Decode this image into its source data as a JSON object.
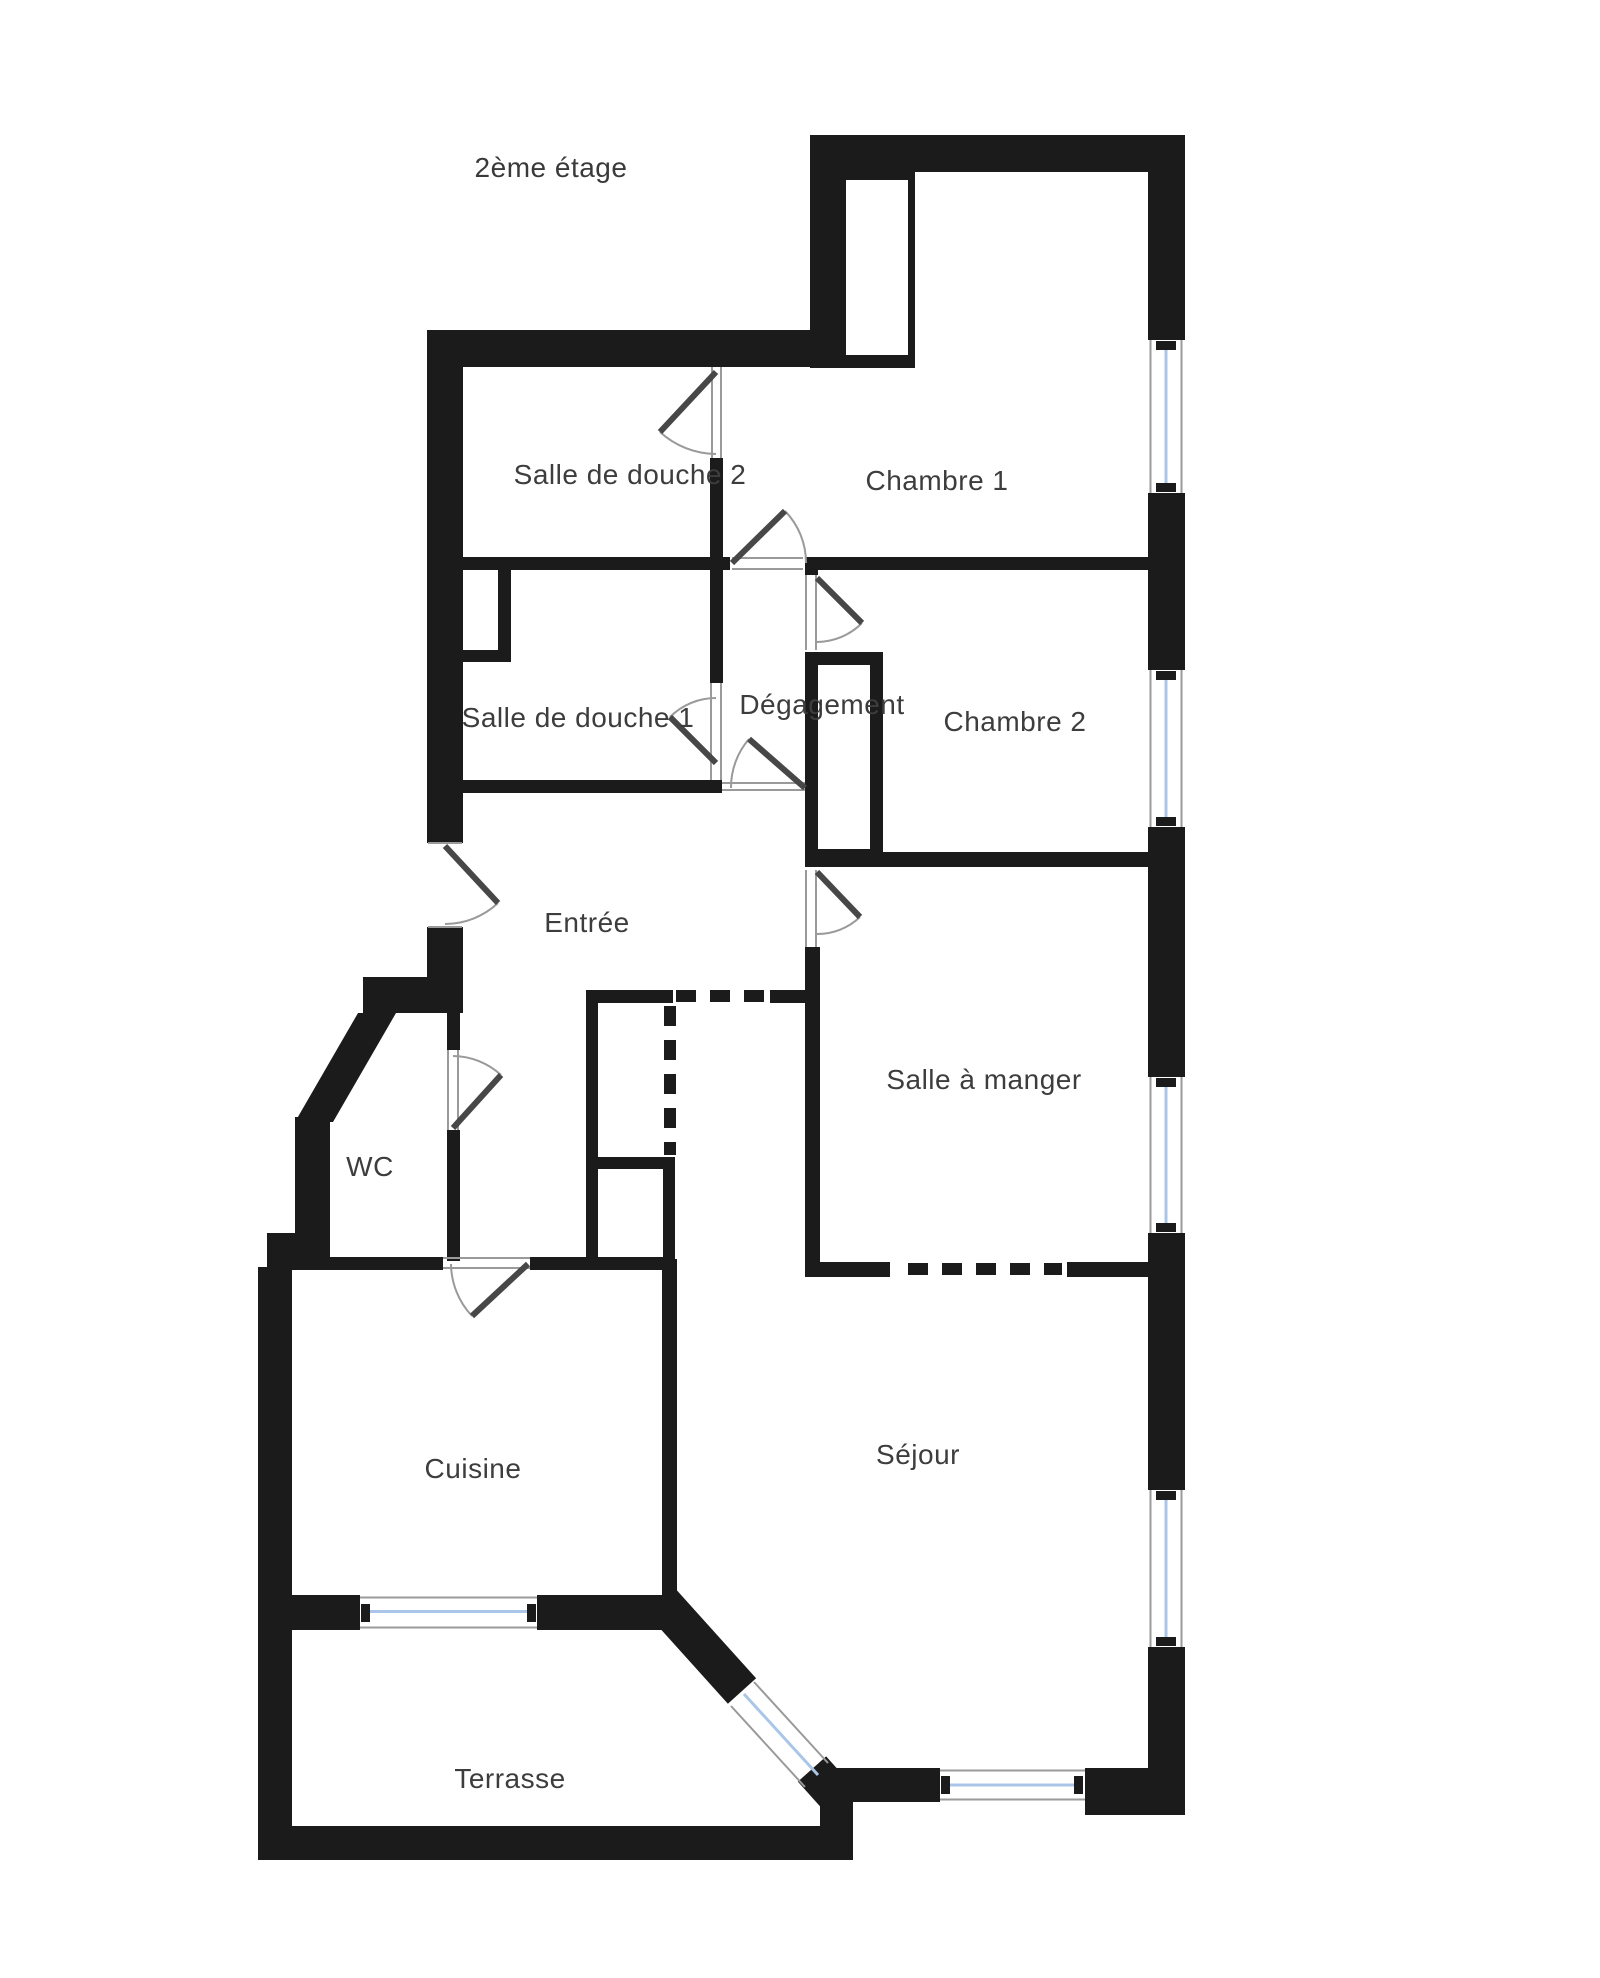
{
  "title": {
    "text": "2ème étage"
  },
  "colors": {
    "wall": "#1b1b1b",
    "leaf": "#474747",
    "arc": "#9a9a9a",
    "thin": "#9a9a9a",
    "glass": "#a9c6e8",
    "label": "#3d3d3d",
    "background": "#ffffff"
  },
  "rooms": [
    {
      "id": "salle-de-douche-2",
      "label": "Salle de douche 2",
      "x": 630,
      "y": 475
    },
    {
      "id": "chambre-1",
      "label": "Chambre 1",
      "x": 937,
      "y": 481
    },
    {
      "id": "salle-de-douche-1",
      "label": "Salle de douche 1",
      "x": 578,
      "y": 718
    },
    {
      "id": "degagement",
      "label": "Dégagement",
      "x": 822,
      "y": 705
    },
    {
      "id": "chambre-2",
      "label": "Chambre 2",
      "x": 1015,
      "y": 722
    },
    {
      "id": "entree",
      "label": "Entrée",
      "x": 587,
      "y": 923
    },
    {
      "id": "salle-a-manger",
      "label": "Salle à manger",
      "x": 984,
      "y": 1080
    },
    {
      "id": "wc",
      "label": "WC",
      "x": 370,
      "y": 1167
    },
    {
      "id": "cuisine",
      "label": "Cuisine",
      "x": 473,
      "y": 1469
    },
    {
      "id": "sejour",
      "label": "Séjour",
      "x": 918,
      "y": 1455
    },
    {
      "id": "terrasse",
      "label": "Terrasse",
      "x": 510,
      "y": 1779
    }
  ],
  "title_pos": {
    "x": 551,
    "y": 168
  },
  "floorplan": {
    "walls": [
      [
        810,
        135,
        375,
        37
      ],
      [
        810,
        172,
        105,
        196
      ],
      [
        427,
        330,
        423,
        37
      ],
      [
        427,
        330,
        36,
        513
      ],
      [
        427,
        927,
        36,
        86
      ],
      [
        363,
        977,
        100,
        36
      ],
      [
        295,
        1117,
        35,
        121
      ],
      [
        267,
        1233,
        63,
        34
      ],
      [
        258,
        1267,
        34,
        559
      ],
      [
        258,
        1826,
        595,
        34
      ],
      [
        258,
        1595,
        102,
        35
      ],
      [
        537,
        1595,
        126,
        35
      ],
      [
        662,
        1259,
        15,
        338
      ],
      [
        1148,
        172,
        37,
        168
      ],
      [
        1148,
        493,
        37,
        177
      ],
      [
        1148,
        827,
        37,
        250
      ],
      [
        1148,
        1233,
        37,
        257
      ],
      [
        1148,
        1647,
        37,
        168
      ],
      [
        827,
        1768,
        113,
        34
      ],
      [
        1085,
        1768,
        100,
        47
      ],
      [
        820,
        1768,
        33,
        92
      ],
      [
        463,
        557,
        267,
        13
      ],
      [
        805,
        557,
        343,
        13
      ],
      [
        805,
        557,
        13,
        18
      ],
      [
        710,
        458,
        13,
        225
      ],
      [
        463,
        780,
        259,
        13
      ],
      [
        498,
        568,
        13,
        94
      ],
      [
        463,
        650,
        48,
        12
      ],
      [
        805,
        652,
        13,
        210
      ],
      [
        805,
        652,
        78,
        13
      ],
      [
        870,
        652,
        13,
        210
      ],
      [
        805,
        849,
        78,
        13
      ],
      [
        805,
        947,
        15,
        330
      ],
      [
        805,
        852,
        343,
        15
      ],
      [
        586,
        990,
        87,
        13
      ],
      [
        770,
        990,
        38,
        13
      ],
      [
        586,
        990,
        12,
        280
      ],
      [
        593,
        1157,
        80,
        12
      ],
      [
        663,
        1157,
        12,
        113
      ],
      [
        447,
        1013,
        13,
        37
      ],
      [
        447,
        1130,
        13,
        131
      ],
      [
        267,
        1257,
        176,
        13
      ],
      [
        530,
        1257,
        133,
        13
      ],
      [
        805,
        1262,
        85,
        15
      ],
      [
        1067,
        1262,
        81,
        15
      ]
    ],
    "white_cores": [
      [
        846,
        180,
        62,
        175
      ]
    ],
    "wall_polygons": [
      "358,1013 295,1122 333,1122 396,1013"
    ],
    "thick_diagonals": [
      [
        660,
        1600,
        742,
        1691
      ],
      [
        812,
        1769,
        838,
        1798
      ]
    ],
    "windows_right": {
      "x": 1147,
      "w": 39,
      "frame_x": [
        1150.5,
        1181.5
      ],
      "glass_x": 1166,
      "nub": {
        "x": 1156,
        "w": 20,
        "h": 9
      },
      "ys": [
        [
          340,
          493
        ],
        [
          670,
          827
        ],
        [
          1077,
          1233
        ],
        [
          1490,
          1647
        ]
      ]
    },
    "windows_h": [
      {
        "rect": [
          360,
          1595,
          177,
          35
        ],
        "frame_y": [
          1597.5,
          1627.5
        ],
        "glass_y": 1611.5,
        "nub_x": [
          361,
          527
        ],
        "nub_y": 1604
      },
      {
        "rect": [
          940,
          1768,
          145,
          34
        ],
        "frame_y": [
          1770.5,
          1799.5
        ],
        "glass_y": 1785,
        "nub_x": [
          941,
          1074
        ],
        "nub_y": 1776
      }
    ],
    "window_diagonal": {
      "glass": [
        744,
        1694,
        818,
        1775
      ],
      "frames": [
        [
          754,
          1682,
          828,
          1763
        ],
        [
          731,
          1706,
          805,
          1787
        ]
      ]
    },
    "dashed": [
      [
        676,
        996,
        768,
        996
      ],
      [
        670,
        1006,
        670,
        1155
      ],
      [
        908,
        1269,
        1062,
        1269
      ]
    ],
    "thin_lines": [
      [
        712,
        367,
        712,
        458
      ],
      [
        721,
        367,
        721,
        458
      ],
      [
        732,
        558,
        803,
        558
      ],
      [
        732,
        569,
        803,
        569
      ],
      [
        806,
        575,
        806,
        650
      ],
      [
        816,
        575,
        816,
        650
      ],
      [
        711,
        683,
        711,
        780
      ],
      [
        721,
        683,
        721,
        780
      ],
      [
        722,
        783,
        805,
        783
      ],
      [
        722,
        790,
        805,
        790
      ],
      [
        806,
        870,
        806,
        947
      ],
      [
        816,
        870,
        816,
        947
      ],
      [
        448,
        1050,
        448,
        1130
      ],
      [
        458,
        1050,
        458,
        1130
      ],
      [
        443,
        1258,
        530,
        1258
      ],
      [
        443,
        1268,
        530,
        1268
      ],
      [
        428,
        843,
        462,
        843
      ],
      [
        428,
        927,
        462,
        927
      ]
    ],
    "doors": [
      {
        "name": "door-salle-de-douche-2",
        "leaf": [
          716,
          372,
          660,
          432
        ],
        "arc": "M660,432 A84,84 0 0 0 716,454"
      },
      {
        "name": "door-chambre-1",
        "leaf": [
          732,
          563,
          785,
          511
        ],
        "arc": "M785,511 A74,74 0 0 1 806,563"
      },
      {
        "name": "door-chambre-2",
        "leaf": [
          817,
          578,
          862,
          623
        ],
        "arc": "M862,623 A64,64 0 0 1 817,642"
      },
      {
        "name": "door-salle-de-douche-1",
        "leaf": [
          716,
          763,
          670,
          717
        ],
        "arc": "M670,717 A65,65 0 0 1 716,698"
      },
      {
        "name": "door-degagement",
        "leaf": [
          805,
          788,
          749,
          739
        ],
        "arc": "M749,739 A74,74 0 0 0 731,788"
      },
      {
        "name": "door-salle-a-manger",
        "leaf": [
          817,
          872,
          860,
          917
        ],
        "arc": "M860,917 A62,62 0 0 1 817,934"
      },
      {
        "name": "door-wc",
        "leaf": [
          453,
          1128,
          501,
          1075
        ],
        "arc": "M501,1075 A72,72 0 0 0 453,1056"
      },
      {
        "name": "door-cuisine",
        "leaf": [
          528,
          1264,
          472,
          1316
        ],
        "arc": "M472,1316 A77,77 0 0 1 451,1264"
      },
      {
        "name": "door-entree",
        "leaf": [
          445,
          846,
          498,
          903
        ],
        "arc": "M498,903 A78,78 0 0 1 445,924"
      }
    ]
  }
}
